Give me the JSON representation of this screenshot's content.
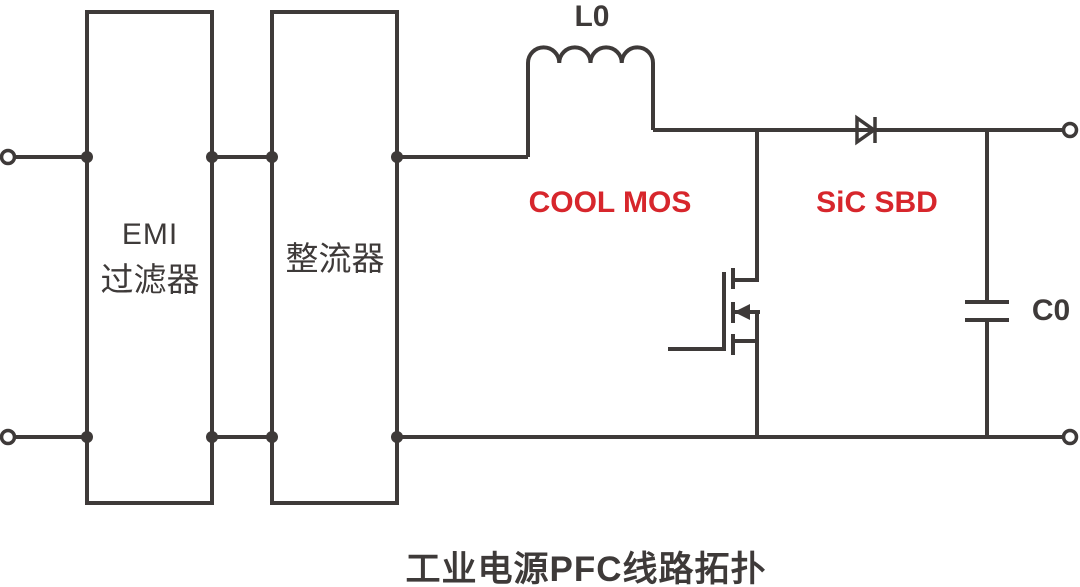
{
  "title": "工业电源PFC线路拓扑",
  "blocks": {
    "emi_filter": {
      "line1": "EMI",
      "line2": "过滤器"
    },
    "rectifier": {
      "label": "整流器"
    }
  },
  "components": {
    "inductor_label": "L0",
    "mosfet_label": "COOL MOS",
    "diode_label": "SiC SBD",
    "capacitor_label": "C0"
  },
  "colors": {
    "line": "#3e3a39",
    "accent_red": "#d7262c",
    "background": "#ffffff"
  }
}
